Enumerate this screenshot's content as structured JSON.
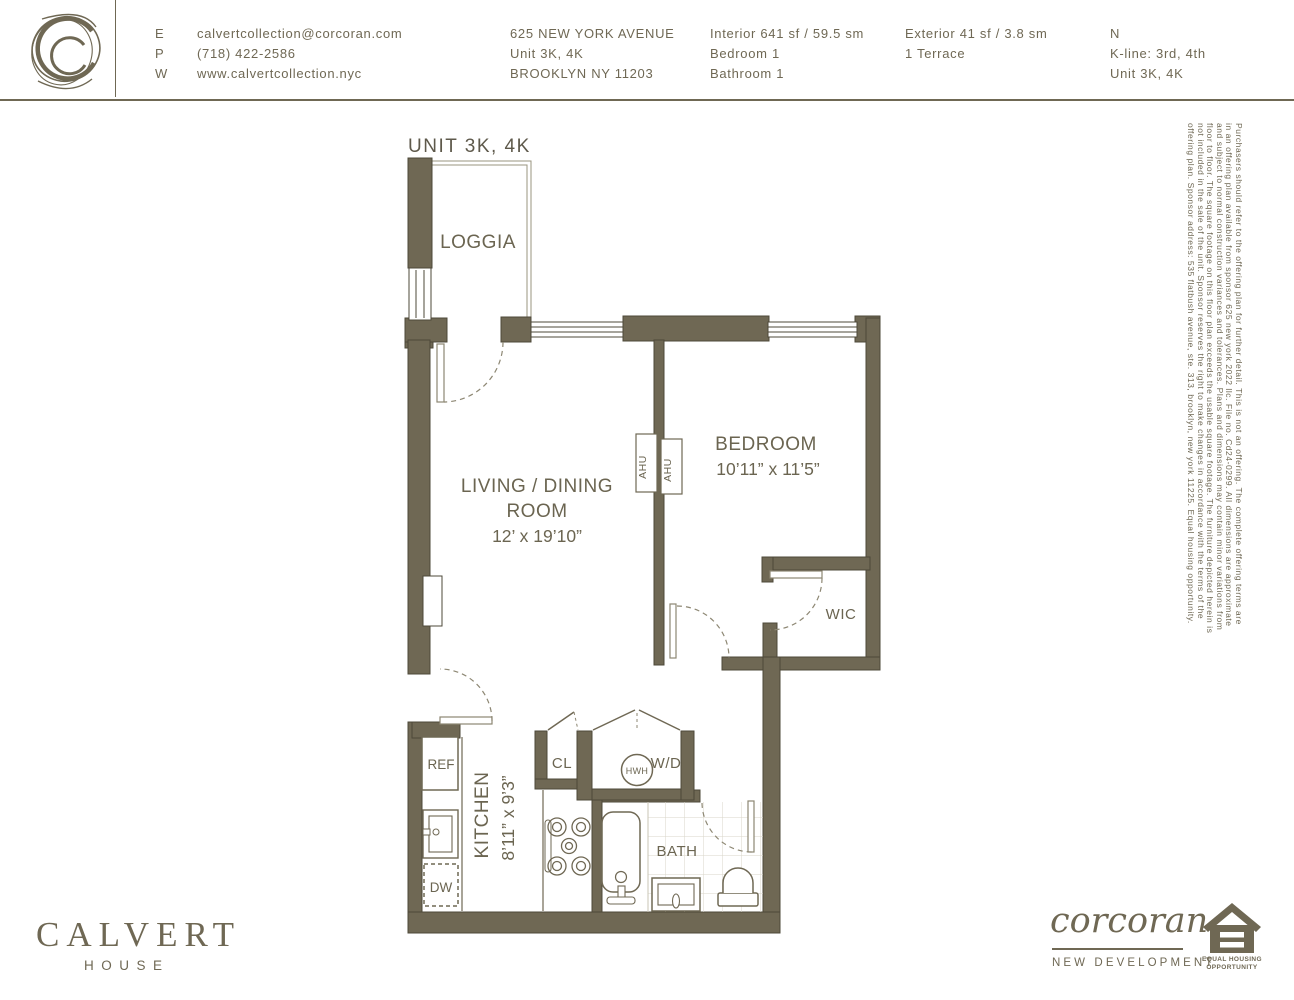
{
  "header": {
    "logo": "calvert-collection-cc-monogram",
    "contact": {
      "email_label": "E",
      "email": "calvertcollection@corcoran.com",
      "phone_label": "P",
      "phone": "(718) 422-2586",
      "web_label": "W",
      "web": "www.calvertcollection.nyc"
    },
    "address": {
      "line1": "625 NEW YORK AVENUE",
      "line2": "Unit 3K, 4K",
      "line3": "BROOKLYN NY 11203"
    },
    "stats_interior": {
      "line1": "Interior 641 sf / 59.5 sm",
      "line2": "Bedroom 1",
      "line3": "Bathroom 1"
    },
    "stats_exterior": {
      "line1": "Exterior 41 sf / 3.8 sm",
      "line2": "1 Terrace"
    },
    "stats_unit": {
      "line1": "N",
      "line2": "K-line: 3rd, 4th",
      "line3": "Unit  3K, 4K"
    }
  },
  "plan": {
    "title": "UNIT 3K, 4K",
    "rooms": {
      "loggia": "LOGGIA",
      "living_line1": "LIVING / DINING",
      "living_line2": "ROOM",
      "living_dims": "12’ x 19’10”",
      "bedroom": "BEDROOM",
      "bedroom_dims": "10’11” x 11’5”",
      "kitchen": "KITCHEN",
      "kitchen_dims": "8’11” x 9’3”",
      "wic": "WIC",
      "bath": "BATH",
      "cl": "CL",
      "wd": "W/D",
      "hwh": "HWH",
      "ref": "REF",
      "dw": "DW",
      "ahu": "AHU"
    }
  },
  "disclaimer": {
    "lines": [
      "Purchasers should refer to the offering plan for further detail. This is not an offering. The complete offering terms are",
      "in an offering plan available from sponsor 625 new york 2022 llc. File no. Cd24-0299.  All dimensions are approximate",
      "and subject to normal construction variances and tolerances. Plans and dimensions may contain minor variations from",
      "floor to floor. The square footage on this floor plan exceeds the usable square footage. The furniture depicted herein is",
      "not included in the sale of the unit. Sponsor reserves the right to make changes in accordance with the terms of the",
      "offering plan. Sponsor address: 535 flatbush avenue, ste. 313, brooklyn, new york 11225. Equal housing opportunity."
    ]
  },
  "footer": {
    "building_name": "CALVERT",
    "building_sub": "HOUSE",
    "brand": "corcoran",
    "brand_sub": "NEW DEVELOPMENT",
    "eho_line1": "EQUAL HOUSING",
    "eho_line2": "OPPORTUNITY"
  },
  "colors": {
    "wall_fill": "#6F6854",
    "wall_outline": "#4D4839",
    "text_olive": "#6F6854",
    "plan_label": "#6B6551",
    "dash_line": "#8D8773",
    "tile_line": "#D8D5CA"
  }
}
